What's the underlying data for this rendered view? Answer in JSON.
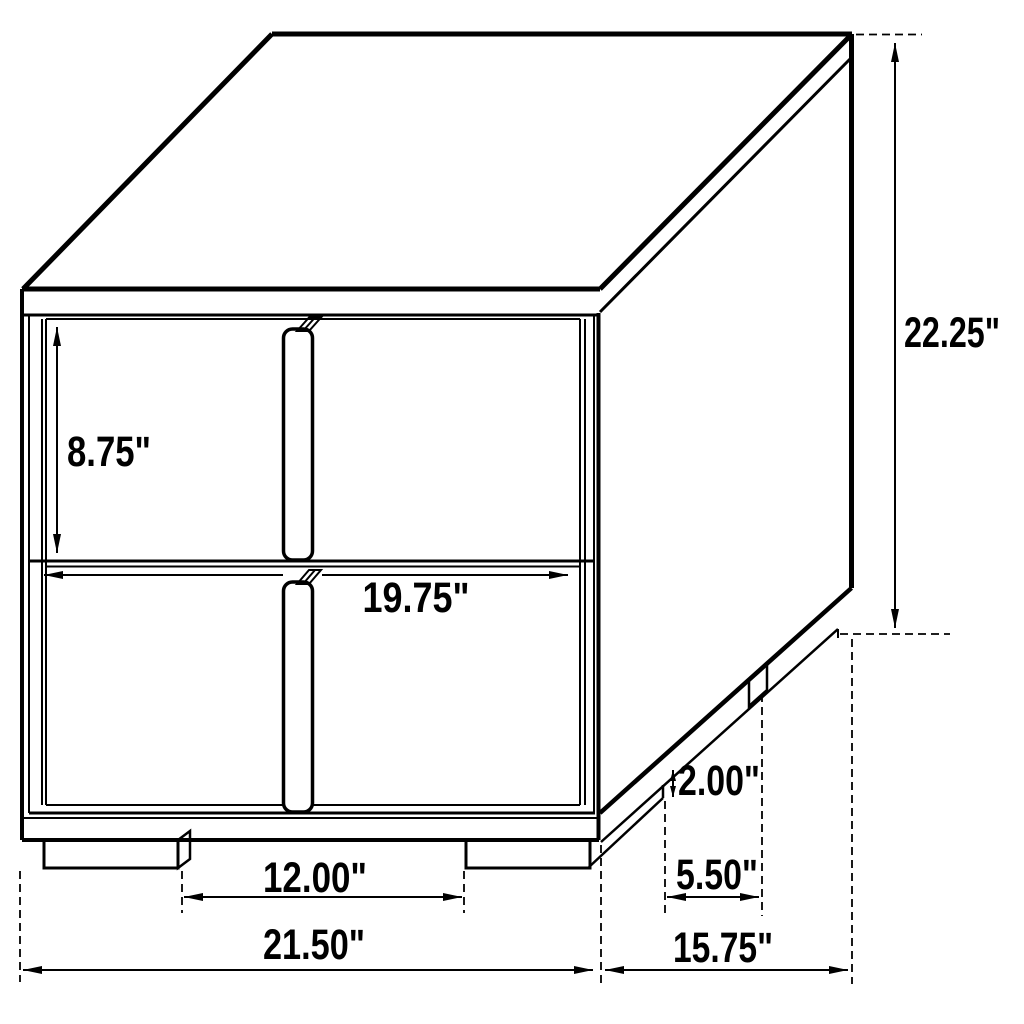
{
  "diagram": {
    "subject": "Two-drawer nightstand technical line drawing with dimensions",
    "style": "black line art on white, oblique 45-degree projection",
    "unit": "inches",
    "colors": {
      "line": "#000000",
      "background": "#ffffff",
      "text": "#000000"
    },
    "dims": {
      "drawer_front_height": {
        "label": "8.75\"",
        "value": 8.75,
        "measures": "drawer front height"
      },
      "total_height": {
        "label": "22.25\"",
        "value": 22.25,
        "measures": "overall height"
      },
      "drawer_width": {
        "label": "19.75\"",
        "value": 19.75,
        "measures": "drawer front width"
      },
      "front_feet_gap": {
        "label": "12.00\"",
        "value": 12.0,
        "measures": "clearance between front feet"
      },
      "total_width": {
        "label": "21.50\"",
        "value": 21.5,
        "measures": "overall width"
      },
      "foot_height": {
        "label": "2.00\"",
        "value": 2.0,
        "measures": "foot height"
      },
      "side_feet_gap": {
        "label": "5.50\"",
        "value": 5.5,
        "measures": "clearance between side feet"
      },
      "total_depth": {
        "label": "15.75\"",
        "value": 15.75,
        "measures": "overall depth"
      }
    }
  }
}
